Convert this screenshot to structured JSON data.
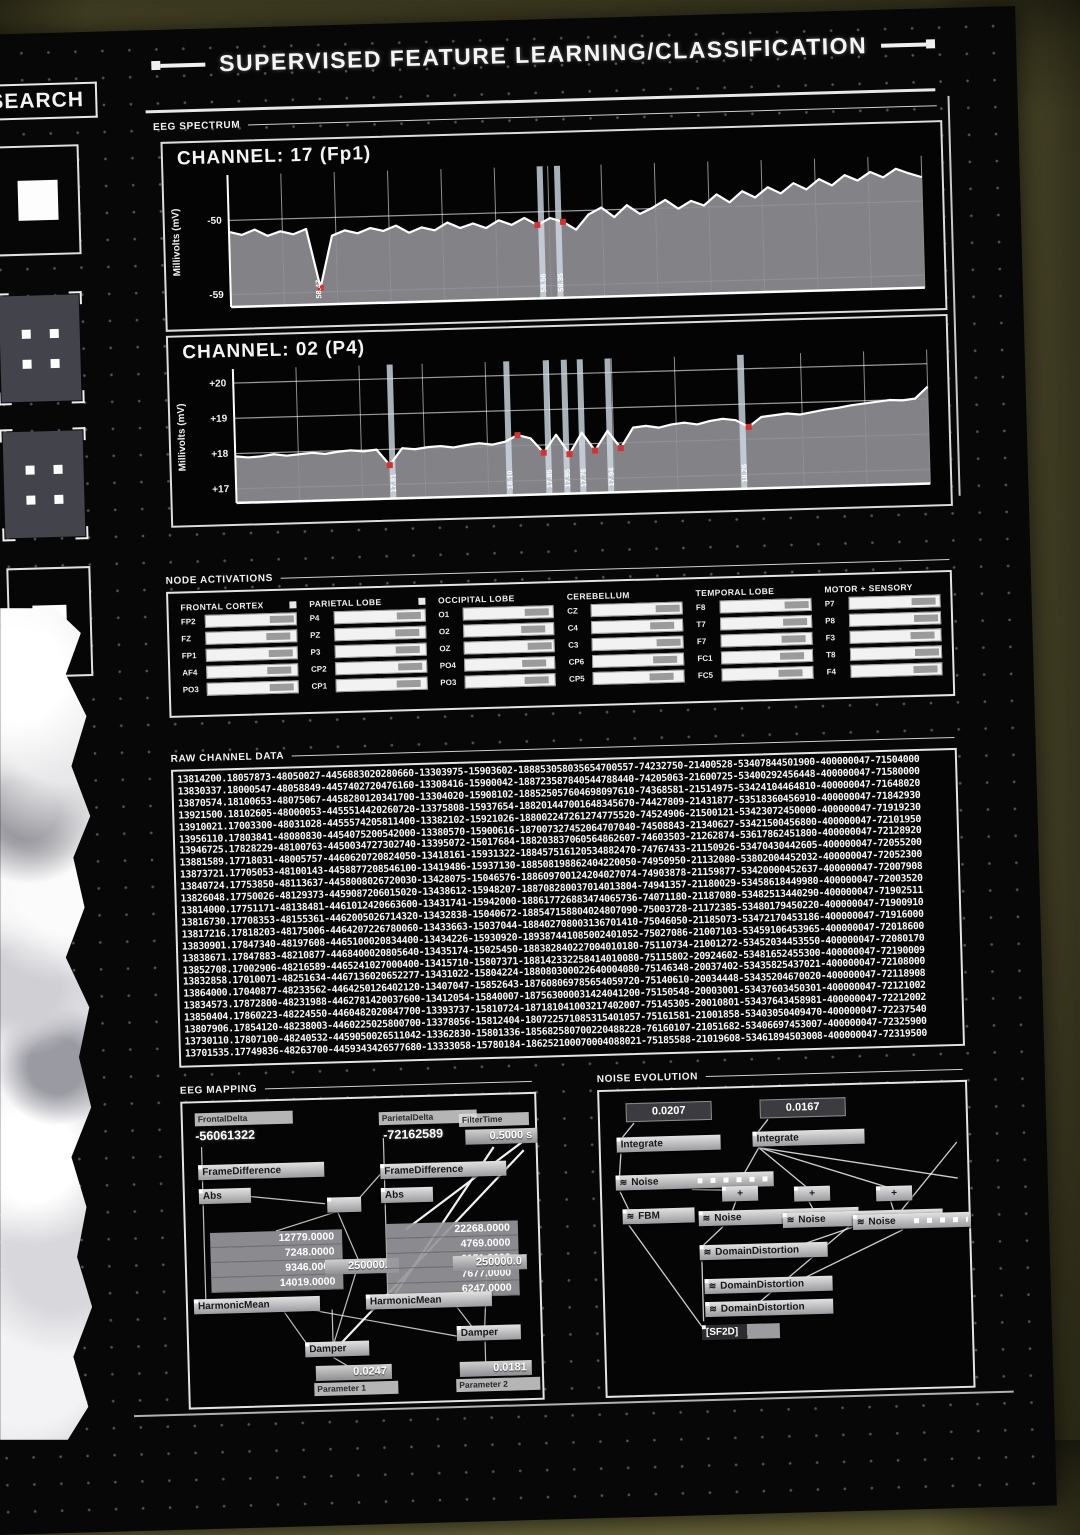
{
  "header": {
    "title": "SUPERVISED FEATURE LEARNING/CLASSIFICATION"
  },
  "sidebar": {
    "search_label": "SEARCH",
    "tiles": [
      "solid-square-tile",
      "marker-grid-tile",
      "marker-grid-tile",
      "nested-square-tile"
    ]
  },
  "sections": {
    "eeg_spectrum": "EEG SPECTRUM",
    "node_activations": "NODE ACTIVATIONS",
    "raw_channel_data": "RAW CHANNEL DATA",
    "eeg_mapping": "EEG MAPPING",
    "noise_evolution": "NOISE EVOLUTION"
  },
  "colors": {
    "accent_red": "#d83030",
    "line_white": "#ffffff",
    "fill_gray": "#8d8d93",
    "wall_olive": "#6e6a3c"
  },
  "chart_data": [
    {
      "type": "line",
      "title": "CHANNEL: 17 (Fp1)",
      "ylabel": "Millivolts (mV)",
      "ylim": [
        -60.5,
        -44.5
      ],
      "yticks": [
        {
          "v": -50,
          "label": "-50"
        },
        {
          "v": -59,
          "label": "-59"
        }
      ],
      "x_gridlines": 13,
      "grid": true,
      "values": [
        -51.4,
        -51.8,
        -51.2,
        -52.0,
        -51.5,
        -51.9,
        -51.3,
        -58.47,
        -52.2,
        -51.6,
        -52.0,
        -51.4,
        -51.8,
        -51.2,
        -52.1,
        -51.5,
        -51.9,
        -51.0,
        -51.7,
        -51.2,
        -51.8,
        -50.9,
        -51.5,
        -50.7,
        -51.6,
        -50.8,
        -51.3,
        -52.3,
        -50.5,
        -49.7,
        -50.9,
        -49.5,
        -50.6,
        -49.9,
        -49.0,
        -50.1,
        -49.2,
        -49.8,
        -48.5,
        -49.5,
        -48.2,
        -49.0,
        -47.8,
        -48.6,
        -47.4,
        -48.2,
        -47.0,
        -47.8,
        -46.6,
        -47.3,
        -46.3,
        -47.0,
        -46.0,
        -46.6,
        -47.1
      ],
      "cursors": [
        {
          "pct": 45.0,
          "label": "58.56"
        },
        {
          "pct": 47.5,
          "label": "58.35"
        }
      ],
      "annotations": [
        {
          "pct": 12.6,
          "label": "58.47"
        }
      ],
      "marker_pcts": [
        12.6,
        45.0,
        47.5
      ]
    },
    {
      "type": "line",
      "title": "CHANNEL: 02 (P4)",
      "ylabel": "Millivolts (mV)",
      "ylim": [
        16.6,
        20.4
      ],
      "yticks": [
        {
          "v": 20,
          "label": "+20"
        },
        {
          "v": 19,
          "label": "+19"
        },
        {
          "v": 18,
          "label": "+18"
        },
        {
          "v": 17,
          "label": "+17"
        }
      ],
      "x_gridlines": 11,
      "grid": true,
      "values": [
        17.92,
        17.88,
        17.9,
        17.95,
        17.9,
        17.93,
        17.96,
        17.92,
        17.97,
        18.0,
        17.96,
        18.0,
        17.55,
        18.02,
        17.98,
        18.03,
        18.05,
        18.0,
        18.06,
        18.1,
        18.05,
        18.12,
        18.3,
        18.2,
        17.78,
        18.28,
        17.72,
        18.32,
        17.8,
        18.35,
        17.85,
        18.42,
        18.46,
        18.4,
        18.48,
        18.52,
        18.46,
        18.55,
        18.6,
        18.55,
        18.35,
        18.62,
        18.66,
        18.7,
        18.66,
        18.72,
        18.78,
        18.82,
        18.88,
        18.92,
        18.96,
        19.0,
        18.98,
        19.02,
        19.35
      ],
      "cursors": [
        {
          "pct": 22.6,
          "label": "17.81"
        },
        {
          "pct": 39.4,
          "label": "18.10"
        },
        {
          "pct": 45.1,
          "label": "17.85"
        },
        {
          "pct": 47.7,
          "label": "17.95"
        },
        {
          "pct": 50.0,
          "label": "17.76"
        },
        {
          "pct": 54.0,
          "label": "17.94"
        },
        {
          "pct": 73.2,
          "label": "18.26"
        }
      ],
      "annotations": [],
      "marker_pcts": [
        22.6,
        40.5,
        44.2,
        47.7,
        51.5,
        55.0,
        73.2
      ]
    }
  ],
  "node_activations": {
    "groups": [
      {
        "name": "FRONTAL CORTEX",
        "checkbox": true,
        "rows": [
          {
            "label": "FP2",
            "level": 1.0
          },
          {
            "label": "FZ",
            "level": 0.9
          },
          {
            "label": "FP1",
            "level": 0.95
          },
          {
            "label": "AF4",
            "level": 0.9
          },
          {
            "label": "PO3",
            "level": 0.95
          }
        ]
      },
      {
        "name": "PARIETAL LOBE",
        "checkbox": true,
        "rows": [
          {
            "label": "P4",
            "level": 0.95
          },
          {
            "label": "PZ",
            "level": 0.9
          },
          {
            "label": "P3",
            "level": 0.9
          },
          {
            "label": "CP2",
            "level": 0.95
          },
          {
            "label": "CP1",
            "level": 0.9
          }
        ]
      },
      {
        "name": "OCCIPITAL LOBE",
        "checkbox": false,
        "rows": [
          {
            "label": "O1",
            "level": 0.95
          },
          {
            "label": "O2",
            "level": 0.85
          },
          {
            "label": "OZ",
            "level": 1.0
          },
          {
            "label": "PO4",
            "level": 0.85
          },
          {
            "label": "PO3",
            "level": 0.9
          }
        ]
      },
      {
        "name": "CEREBELLUM",
        "checkbox": false,
        "rows": [
          {
            "label": "CZ",
            "level": 1.0
          },
          {
            "label": "C4",
            "level": 0.85
          },
          {
            "label": "C3",
            "level": 1.0
          },
          {
            "label": "CP6",
            "level": 0.9
          },
          {
            "label": "CP5",
            "level": 0.8
          }
        ]
      },
      {
        "name": "TEMPORAL LOBE",
        "checkbox": false,
        "rows": [
          {
            "label": "F8",
            "level": 1.0
          },
          {
            "label": "T7",
            "level": 0.95
          },
          {
            "label": "F7",
            "level": 0.9
          },
          {
            "label": "FC1",
            "level": 0.85
          },
          {
            "label": "FC5",
            "level": 0.8
          }
        ]
      },
      {
        "name": "MOTOR + SENSORY",
        "checkbox": false,
        "rows": [
          {
            "label": "P7",
            "level": 0.95
          },
          {
            "label": "P8",
            "level": 1.0
          },
          {
            "label": "F3",
            "level": 0.9
          },
          {
            "label": "T8",
            "level": 1.0
          },
          {
            "label": "F4",
            "level": 0.95
          }
        ]
      }
    ]
  },
  "raw_channel_data": {
    "rows": [
      "13814200.18057873-48050027-4456883020280660-13303975-15903602-188853058035654700557-74232750-21400528-53407844501900-400000047-71504000",
      "13830337.18000547-48058849-4457402720476160-13308416-15900042-188723587840544788440-74205063-21600725-53400292456448-400000047-71580000",
      "13870574.18100653-48075067-4458280120341700-13304020-15908102-188525057604698097610-74368581-21514975-53424104464810-400000047-71648020",
      "13921500.18102605-48000053-4455514420260720-13375808-15937654-188201447001648345670-74427809-21431877-53518360456910-400000047-71842930",
      "13910021.17003300-48031028-4455574205811400-13382102-15921026-188002247261274775520-74524906-21500121-53423072450000-400000047-71919230",
      "13956110.17803841-48080830-4454075200542000-13380570-15900616-187007327452064707040-74508843-21340627-53421500456800-400000047-72101950",
      "13946725.17828229-48100763-4450034727302740-13395072-15017684-188203837060564862607-74603503-21262874-53617862451800-400000047-72128920",
      "13881589.17718031-48005757-4460620720824050-13418161-15931322-188457516120534882470-74767433-21150926-53470430442605-400000047-72055200",
      "13873721.17705053-48100143-4458877208546100-13419486-15937130-188508198862404220050-74950950-21132080-53802004452032-400000047-72052300",
      "13840724.17753850-48113637-4458008026720030-13428075-15046576-188609700124204027074-74903878-21159877-53420000452637-400000047-72007908",
      "13826048.17750026-48129373-4459087206015020-13438612-15948207-188708280037014013804-74941357-21180029-53458618449980-400000047-72003520",
      "13814000.17751171-48138481-4461012420663600-13431741-15942000-188617726883474065736-74071180-21187080-53482513440290-400000047-71902511",
      "13816730.17708353-48155361-4462005026714320-13432838-15040672-188547158804024807090-75003728-21172385-53480179450220-400000047-71900910",
      "13817216.17818203-48175006-4464207226780060-13433663-15037044-188402708003136701410-75046050-21185073-53472170453186-400000047-71916000",
      "13830901.17847340-48197608-4465100020834400-13434226-15930920-189387441085002401052-75027086-21007103-53459106453965-400000047-72018600",
      "13838671.17847883-48210877-4468400020805640-13435174-15025450-188382840227004010180-75110734-21001272-53452034453550-400000047-72080170",
      "13852708.17002906-48216589-4465241027000400-13415710-15807371-188142332258414010080-75115802-20924602-53481652455300-400000047-72190009",
      "13832858.17010071-48251634-4467136020652277-13431022-15804224-188080300022640004080-75146348-20037402-53435825437021-400000047-72108000",
      "13864000.17040877-48233562-4464250126402120-13407047-15852643-187608069785654059720-75140610-20034448-53435204670020-400000047-72118908",
      "13834573.17872800-48231988-4462781420037600-13412054-15840007-187563000031424041200-75150548-20003001-53437603450301-400000047-72121002",
      "13850404.17860223-48224550-4460482020847700-13393737-15810724-187181041003217402007-75145305-20010801-53437643458981-400000047-72212002",
      "13807906.17854120-48238003-4460225025800700-13378056-15812404-180722571085315401057-75161581-21001858-53403050409470-400000047-72237540",
      "13730110.17807100-48240532-4459050026511042-13362830-15801336-185682580700220488228-76160107-21051682-53406697453007-400000047-72325900",
      "13701535.17749836-48263700-4459343426577680-13333058-15780184-186252100070004088021-75185588-21019608-53461894503008-400000047-72319500"
    ]
  },
  "eeg_mapping": {
    "left": {
      "tag": "FrontalDelta",
      "value": "-56061322",
      "op1": "FrameDifference",
      "op2": "Abs",
      "list": [
        "12779.0000",
        "7248.0000",
        "9346.0000",
        "14019.0000"
      ],
      "mean": "HarmonicMean",
      "gain": "250000.0",
      "damper": "Damper",
      "result": "0.0247",
      "param": "Parameter 1"
    },
    "right": {
      "tag": "ParietalDelta",
      "value": "-72162589",
      "op1": "FrameDifference",
      "op2": "Abs",
      "list": [
        "22268.0000",
        "4769.0000",
        "6151.0000",
        "7677.0000",
        "6247.0000"
      ],
      "mean": "HarmonicMean",
      "gain": "250000.0",
      "damper": "Damper",
      "result": "0.0181",
      "param": "Parameter 2"
    },
    "filter": {
      "tag": "FilterTime",
      "value": "0.5000 s"
    }
  },
  "noise_evolution": {
    "inputs": [
      "0.0207",
      "0.0167"
    ],
    "integrate": "Integrate",
    "noise": "Noise",
    "fbm": "FBM",
    "plus": "+",
    "domain": "DomainDistortion",
    "sf2d": "[SF2D]",
    "wave_icon": "≋"
  }
}
